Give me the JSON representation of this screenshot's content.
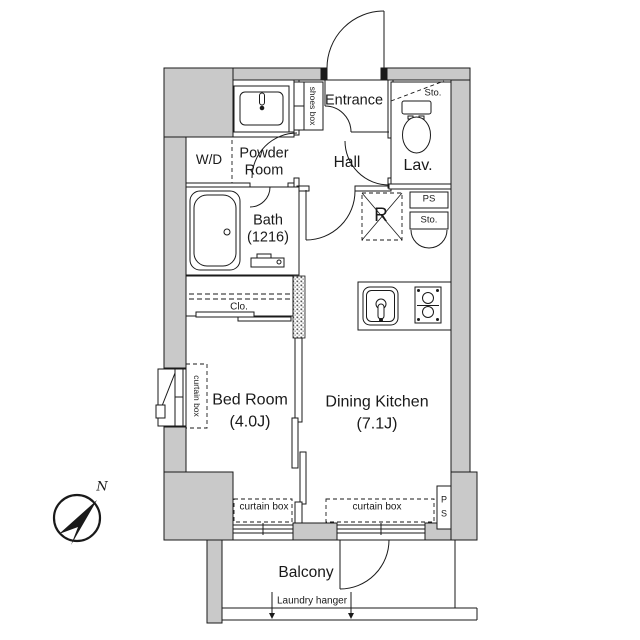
{
  "colors": {
    "wall_fill": "#c9c9c9",
    "line": "#1a1a1a",
    "background": "#ffffff"
  },
  "rooms": {
    "entrance": {
      "label": "Entrance"
    },
    "hall": {
      "label": "Hall"
    },
    "lav": {
      "label": "Lav."
    },
    "powder_room": {
      "line1": "Powder",
      "line2": "Room"
    },
    "bath": {
      "label": "Bath",
      "size": "(1216)"
    },
    "bed_room": {
      "label": "Bed Room",
      "size": "(4.0J)"
    },
    "dining_kitchen": {
      "label": "Dining Kitchen",
      "size": "(7.1J)"
    },
    "balcony": {
      "label": "Balcony"
    }
  },
  "features": {
    "wd": "W/D",
    "shoes_box": "shoes box",
    "lav_storage": "Sto.",
    "pipe_space_upper": "PS",
    "storage_mid": "Sto.",
    "refrigerator": "R",
    "closet": "Clo.",
    "curtain_box_left": "curtain box",
    "curtain_box_bedroom": "curtain box",
    "curtain_box_dk": "curtain box",
    "pipe_space_lower": "P\nS",
    "laundry_hanger": "Laundry hanger"
  },
  "compass": {
    "north_label": "N"
  }
}
